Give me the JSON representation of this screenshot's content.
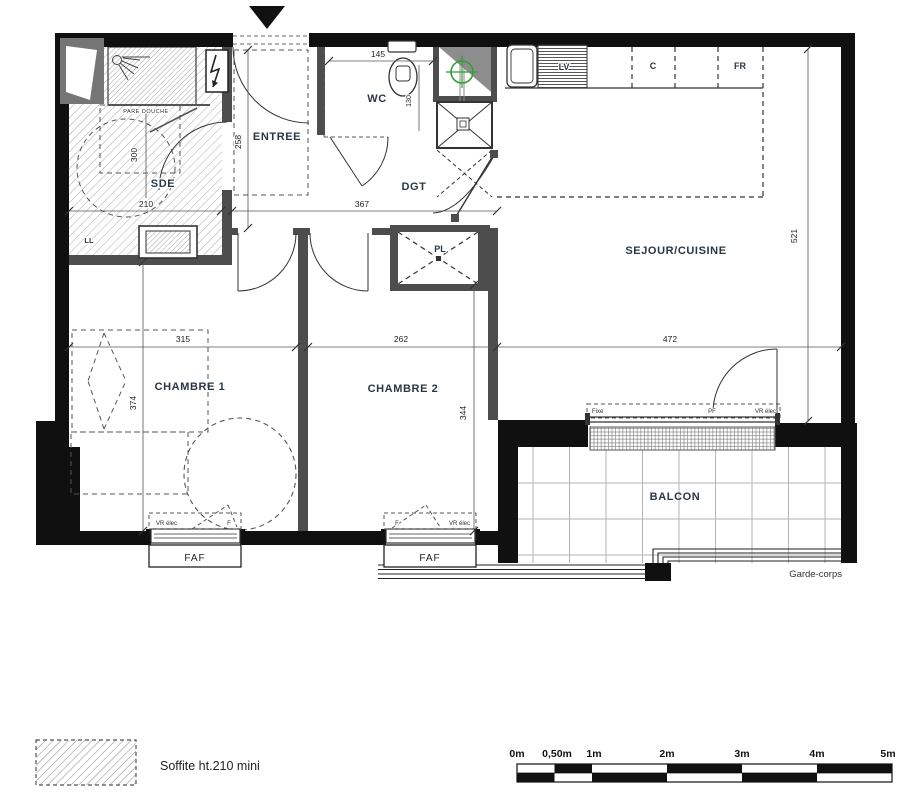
{
  "plan": {
    "rooms": {
      "sde": "SDE",
      "entree": "ENTREE",
      "wc": "WC",
      "dgt": "DGT",
      "sejour_cuisine": "SEJOUR/CUISINE",
      "chambre1": "CHAMBRE 1",
      "chambre2": "CHAMBRE 2",
      "balcon": "BALCON"
    },
    "equipment": {
      "pare_douche": "PARE DOUCHE",
      "lave_linge": "LL",
      "placard": "PL",
      "lave_vaisselle": "LV",
      "cuisson": "C",
      "refrigerateur": "FR"
    },
    "openings": {
      "fixe": "Fixe",
      "pf": "PF",
      "vr_elec": "VR élec",
      "fenetre": "F",
      "faf": "FAF"
    },
    "railing": "Garde-corps",
    "dimensions_cm": {
      "sde_height": "300",
      "sde_width": "210",
      "entree_depth": "258",
      "wc_width": "145",
      "wc_depth": "130",
      "degagement_width": "367",
      "sejour_width": "472",
      "sejour_height": "521",
      "chambre1_width": "315",
      "chambre1_height": "374",
      "chambre2_width": "262",
      "chambre2_height": "344"
    }
  },
  "legend": {
    "soffite_label": "Soffite ht.210 mini"
  },
  "scale_bar": {
    "labels": [
      "0m",
      "0,50m",
      "1m",
      "2m",
      "3m",
      "4m",
      "5m"
    ]
  }
}
